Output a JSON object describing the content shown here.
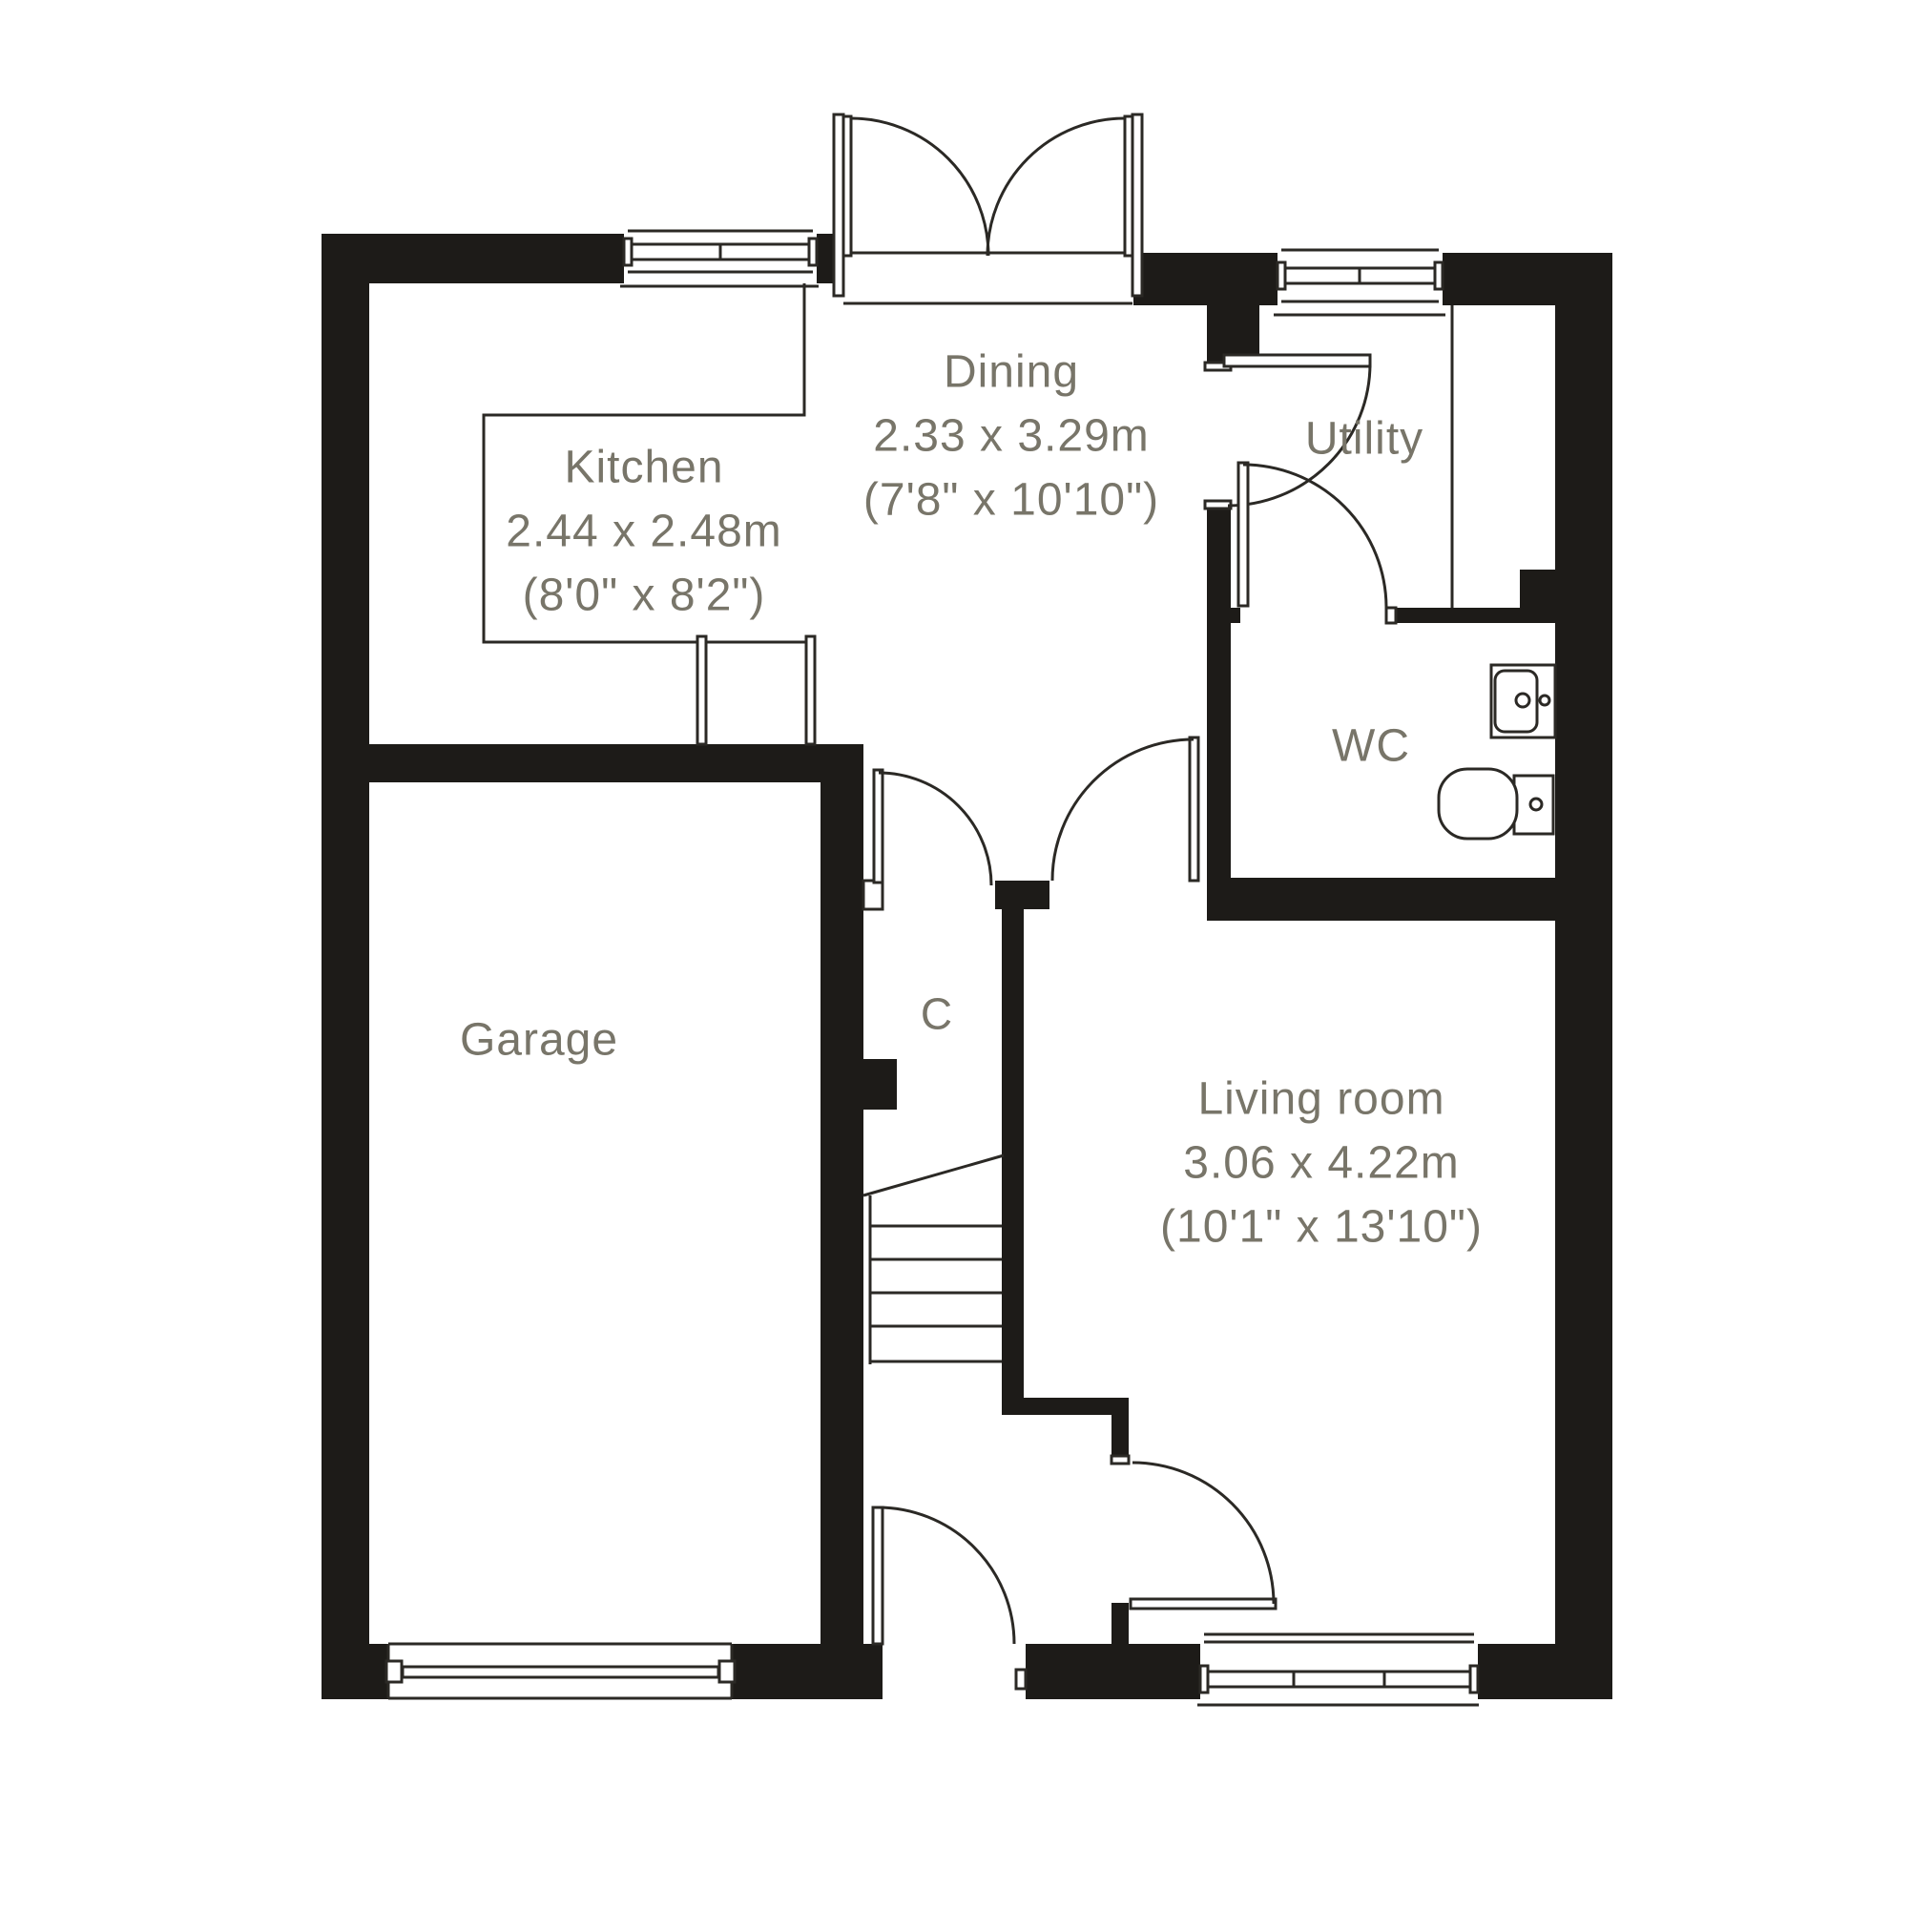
{
  "plan": {
    "rooms": {
      "kitchen": {
        "name": "Kitchen",
        "metric": "2.44 x 2.48m",
        "imperial": "(8'0\" x 8'2\")"
      },
      "dining": {
        "name": "Dining",
        "metric": "2.33 x 3.29m",
        "imperial": "(7'8\" x 10'10\")"
      },
      "utility": {
        "name": "Utility"
      },
      "wc": {
        "name": "WC"
      },
      "cupboard": {
        "name": "C"
      },
      "garage": {
        "name": "Garage"
      },
      "living": {
        "name": "Living room",
        "metric": "3.06 x 4.22m",
        "imperial": "(10'1\" x 13'10\")"
      }
    },
    "colors": {
      "wall": "#1d1b18",
      "line": "#2b2925",
      "label": "#787569",
      "background": "#ffffff"
    }
  }
}
